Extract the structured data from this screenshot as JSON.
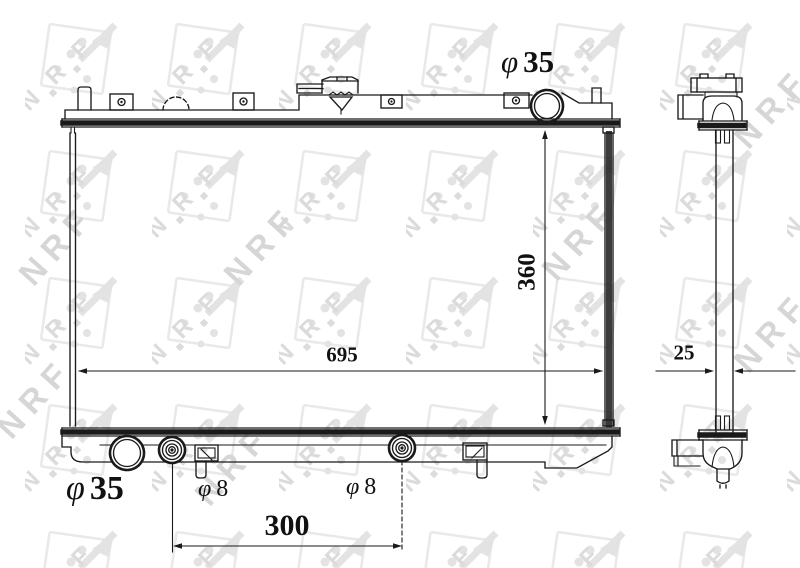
{
  "watermark": {
    "brand": "NRF",
    "letters": [
      "N",
      "R",
      "F"
    ]
  },
  "colors": {
    "line": "#1a1a1a",
    "background": "#ffffff",
    "watermark_light": "#e6e6e6",
    "watermark_mid": "#d6d6d6"
  },
  "dimensions": {
    "top_inlet": {
      "symbol": "φ",
      "value": "35"
    },
    "core_height": {
      "value": "360"
    },
    "core_width": {
      "value": "695"
    },
    "core_depth": {
      "value": "25"
    },
    "bottom_outlet": {
      "symbol": "φ",
      "value": "35"
    },
    "left_fitting": {
      "symbol": "φ",
      "value": "8"
    },
    "right_fitting": {
      "symbol": "φ",
      "value": "8"
    },
    "fitting_spacing": {
      "value": "300"
    }
  }
}
